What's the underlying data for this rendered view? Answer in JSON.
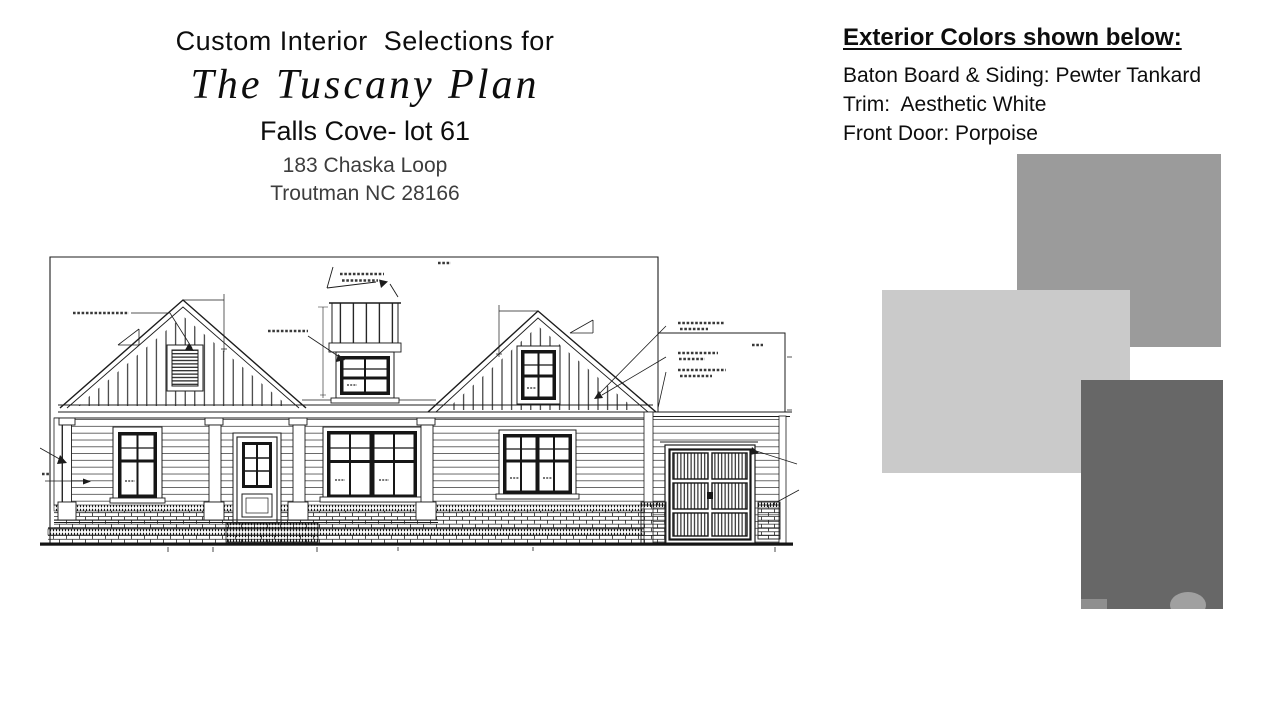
{
  "title_block": {
    "line1": "Custom Interior  Selections for",
    "plan_name": "The Tuscany Plan",
    "community_lot": "Falls Cove- lot 61",
    "address_line1": "183 Chaska Loop",
    "address_line2": "Troutman NC 28166"
  },
  "exterior_colors": {
    "heading": "Exterior Colors shown below:",
    "specs": [
      {
        "label": "Baton Board & Siding: Pewter Tankard"
      },
      {
        "label": "Trim:  Aesthetic White"
      },
      {
        "label": "Front Door: Porpoise"
      }
    ],
    "swatches": [
      {
        "name": "pewter-tankard",
        "color": "#9b9b9b"
      },
      {
        "name": "aesthetic-white",
        "color": "#cacaca"
      },
      {
        "name": "porpoise",
        "color": "#676767"
      }
    ]
  },
  "drawing": {
    "icon": "house-front-elevation-line-drawing",
    "ink": "#1c1c1c"
  }
}
